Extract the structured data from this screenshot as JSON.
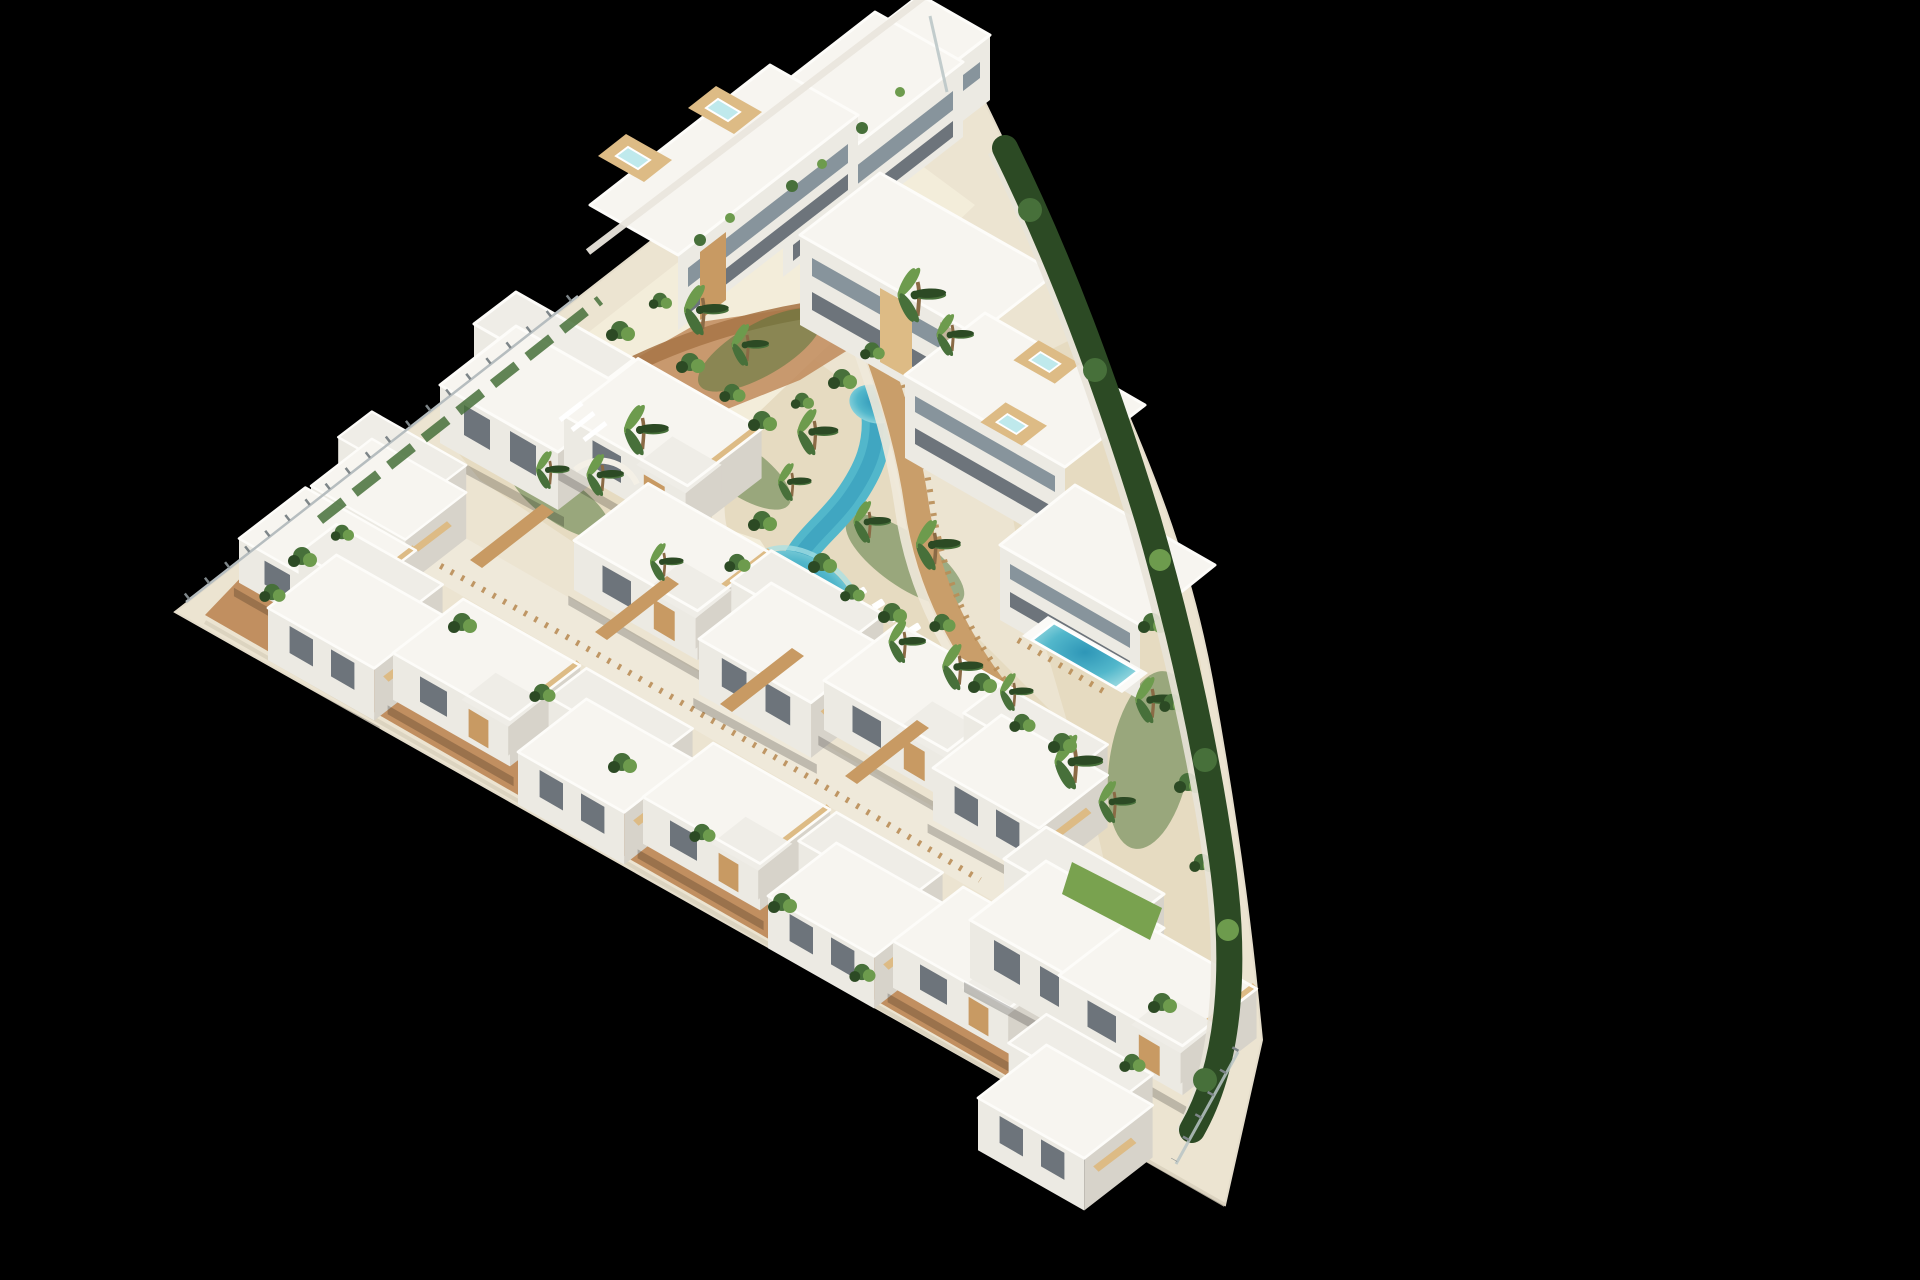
{
  "meta": {
    "type": "architectural-3d-render",
    "description": "Aerial 3D render of a white Mediterranean residential resort complex on a triangular plot, floating on a black background. A turquoise lazy-river lagoon pool winds through the centre, bordered by sandy beach areas, palm trees, wooden boardwalks and rows of white flat-roofed villas and apartment blocks with rooftop jacuzzi terraces.",
    "canvas": {
      "width": 1920,
      "height": 1280
    }
  },
  "scene": {
    "background": "#000000",
    "palette": {
      "site_base": "#ece4d1",
      "site_edge": "#d8cfbc",
      "building_top": "#f7f5f0",
      "building_front": "#eceae3",
      "building_side": "#d7d3ca",
      "roof_deck": "#fbfaf7",
      "glass_dark": "#6d747b",
      "wood": "#c89a63",
      "wood_light": "#ddbb85",
      "stone": "#c2b49a",
      "terracotta": "#bf8a5a",
      "terracotta_deep": "#a97748",
      "boardwalk": "#c99e6a",
      "garden_sand": "#e6dbc1",
      "beach_sand": "#f3edda",
      "path_cream": "#f0e9da",
      "pool_deep": "#2e96b7",
      "pool_mid": "#52b7cb",
      "pool_shallow": "#a7e0e4",
      "green_dark": "#2c4a24",
      "green_mid": "#47703a",
      "green_light": "#6d9b4d",
      "lawn": "#79a24f",
      "fence_glass": "#b9c4c6",
      "wall_white": "#efece4"
    },
    "objects": [
      {
        "name": "site-platform",
        "description": "triangular model base with straight north-west and south-west edges and a curved eastern boundary"
      },
      {
        "name": "top-apartment-row",
        "description": "stepped row of three-storey apartment blocks along the north-west edge, rooftop terraces with wooden decks and small jacuzzis"
      },
      {
        "name": "right-apartment-row",
        "description": "three stepped apartment blocks along the east side with balconies, rooftop jacuzzis and a private rectangular pool"
      },
      {
        "name": "villa-row-inner",
        "description": "row of white two-storey villas facing the central garden"
      },
      {
        "name": "villa-row-outer",
        "description": "row of white villas along the south-west edge with terracotta terraces"
      },
      {
        "name": "left-villa-cluster",
        "description": "villas at the western tip behind a glass perimeter fence"
      },
      {
        "name": "central-villa-cluster",
        "description": "villas with decorative fin walls near the centre-left"
      },
      {
        "name": "bottom-right-villa-cluster",
        "description": "cluster of larger villas at the south-east corner"
      },
      {
        "name": "lazy-river-pool",
        "description": "winding turquoise lagoon pool with beach entries"
      },
      {
        "name": "private-pool",
        "description": "small rectangular blue pool beside the lowest east block"
      },
      {
        "name": "wooden-boardwalk",
        "description": "curved timber walkway with slatted fences along the east bank of the pool"
      },
      {
        "name": "footbridge",
        "description": "small wooden bridge crossing the pool channel"
      },
      {
        "name": "sun-loungers",
        "description": "white loungers on the beach sand"
      },
      {
        "name": "palm-trees",
        "description": "palm trees scattered along the pool and gardens"
      },
      {
        "name": "shrubs",
        "description": "green shrub planting throughout the gardens"
      },
      {
        "name": "boundary-hedge",
        "description": "dark green hedge running down the curved eastern boundary"
      },
      {
        "name": "perimeter-fence",
        "description": "thin glass/metal fence along the north-west edge and corners"
      },
      {
        "name": "lawn-patch",
        "description": "small bright green lawn near the south-east garden"
      },
      {
        "name": "terracotta-terraces",
        "description": "terracotta paved terraces between the villa rows"
      }
    ]
  }
}
